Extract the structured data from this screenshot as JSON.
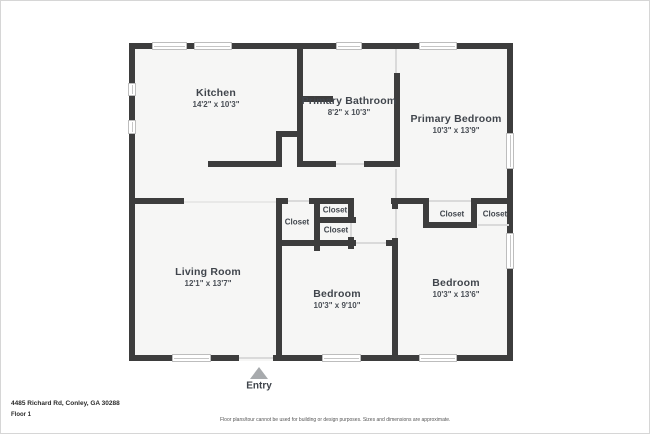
{
  "floorplan": {
    "address": "4485 Richard Rd, Conley, GA 30288",
    "floor_label": "Floor 1",
    "disclaimer": "Floor plans/tour cannot be used for building or design purposes. Sizes and dimensions are approximate.",
    "entry_label": "Entry",
    "rooms": [
      {
        "name": "Kitchen",
        "dimensions": "14'2\" x 10'3\""
      },
      {
        "name": "Primary Bathroom",
        "dimensions": "8'2\" x 10'3\""
      },
      {
        "name": "Primary Bedroom",
        "dimensions": "10'3\" x 13'9\""
      },
      {
        "name": "Living Room",
        "dimensions": "12'1\" x 13'7\""
      },
      {
        "name": "Bedroom",
        "dimensions": "10'3\" x 9'10\""
      },
      {
        "name": "Bedroom",
        "dimensions": "10'3\" x 13'6\""
      }
    ],
    "closet_labels": [
      "Closet",
      "Closet",
      "Closet",
      "Closet",
      "Closet"
    ],
    "colors": {
      "wall": "#3d3d3d",
      "floor": "#f6f6f5",
      "window_border": "#bdbdbd",
      "entry_arrow": "#a7aaad",
      "label_text": "#40454c"
    }
  }
}
